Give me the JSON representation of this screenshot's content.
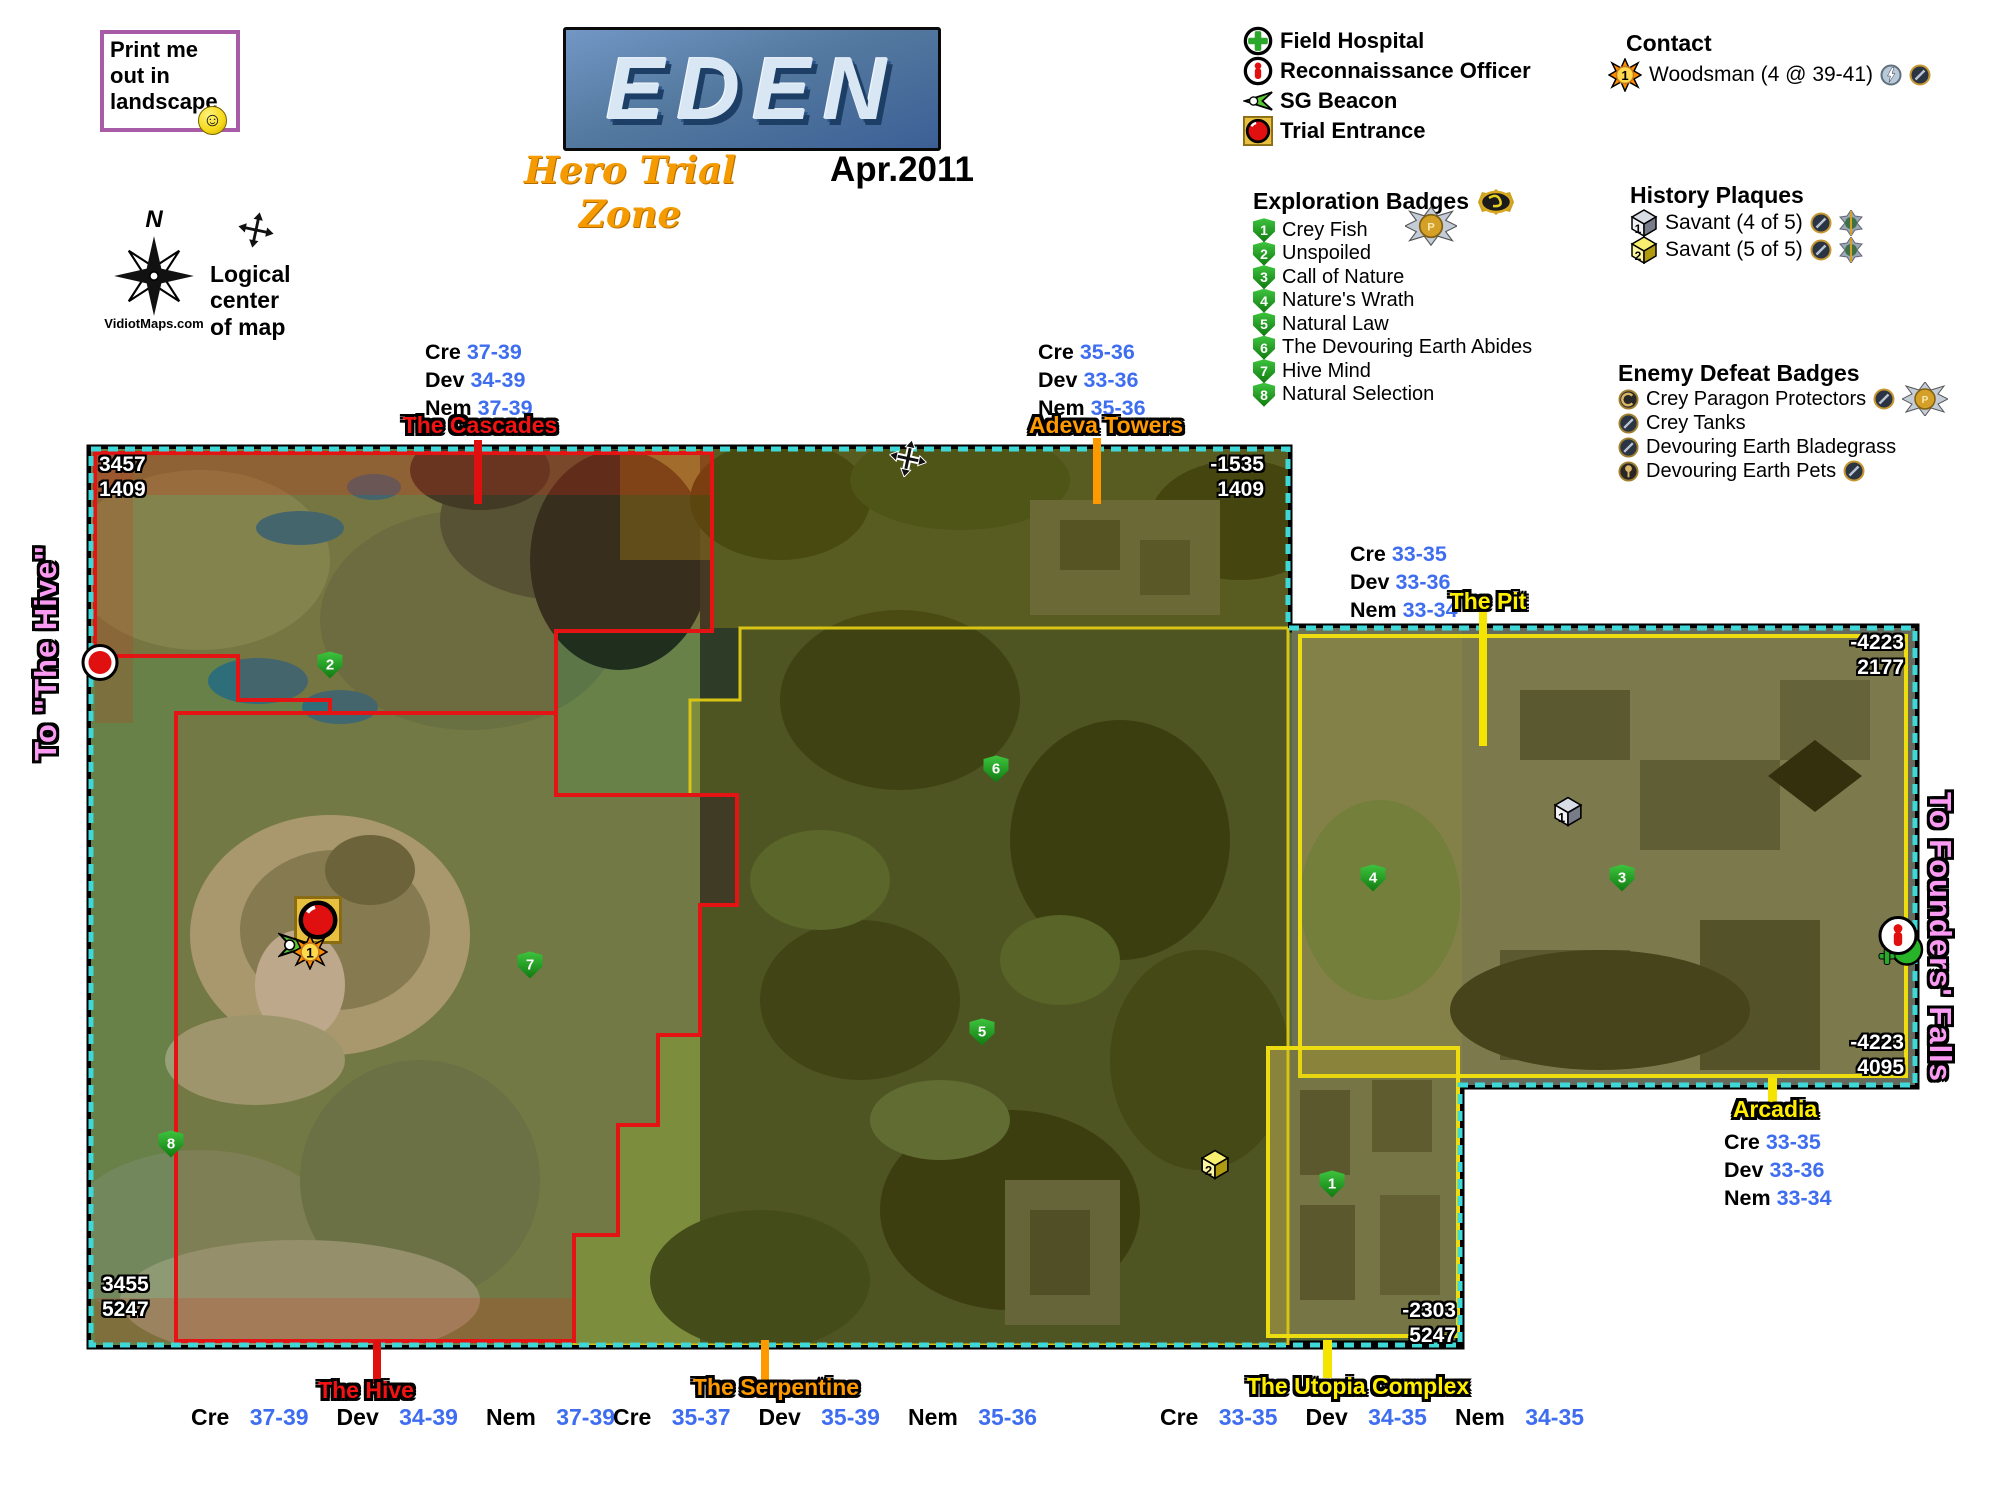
{
  "print_note": {
    "text": "Print me out in landscape",
    "smiley": "☺"
  },
  "title": {
    "name": "EDEN",
    "subtitle": "Hero Trial Zone",
    "date": "Apr.2011"
  },
  "compass": {
    "north": "N",
    "site": "VidiotMaps.com",
    "logical_center": "Logical center of map"
  },
  "legend": {
    "items": [
      {
        "icon": "field-hospital-icon",
        "label": "Field Hospital"
      },
      {
        "icon": "recon-officer-icon",
        "label": "Reconnaissance Officer"
      },
      {
        "icon": "sg-beacon-icon",
        "label": "SG Beacon"
      },
      {
        "icon": "trial-entrance-icon",
        "label": "Trial Entrance"
      }
    ]
  },
  "contact": {
    "heading": "Contact",
    "number": "1",
    "label": "Woodsman (4 @ 39-41)"
  },
  "exploration": {
    "heading": "Exploration Badges",
    "items": [
      {
        "num": "1",
        "label": "Crey Fish"
      },
      {
        "num": "2",
        "label": "Unspoiled"
      },
      {
        "num": "3",
        "label": "Call of Nature"
      },
      {
        "num": "4",
        "label": "Nature's Wrath"
      },
      {
        "num": "5",
        "label": "Natural Law"
      },
      {
        "num": "6",
        "label": "The Devouring Earth Abides"
      },
      {
        "num": "7",
        "label": "Hive Mind"
      },
      {
        "num": "8",
        "label": "Natural Selection"
      }
    ]
  },
  "history": {
    "heading": "History Plaques",
    "items": [
      {
        "num": "1",
        "label": "Savant (4 of 5)",
        "style": "grey"
      },
      {
        "num": "2",
        "label": "Savant (5 of 5)",
        "style": "gold"
      }
    ]
  },
  "enemy": {
    "heading": "Enemy Defeat Badges",
    "items": [
      {
        "label": "Crey Paragon Protectors"
      },
      {
        "label": "Crey Tanks"
      },
      {
        "label": "Devouring Earth Bladegrass"
      },
      {
        "label": "Devouring Earth Pets"
      }
    ]
  },
  "sides": {
    "left": "To \"The Hive\"",
    "right": "To Founders' Falls"
  },
  "stat_labels": {
    "cre": "Cre",
    "dev": "Dev",
    "nem": "Nem"
  },
  "zones": [
    {
      "name": "The Cascades",
      "color": "#f21212",
      "cre": "37-39",
      "dev": "34-39",
      "nem": "37-39"
    },
    {
      "name": "Adeva Towers",
      "color": "#ff9900",
      "cre": "35-36",
      "dev": "33-36",
      "nem": "35-36"
    },
    {
      "name": "The Pit",
      "color": "#ffee00",
      "cre": "33-35",
      "dev": "33-36",
      "nem": "33-34"
    },
    {
      "name": "Arcadia",
      "color": "#ffee00",
      "cre": "33-35",
      "dev": "33-36",
      "nem": "33-34"
    },
    {
      "name": "The Hive",
      "color": "#f21212",
      "cre": "37-39",
      "dev": "34-39",
      "nem": "37-39"
    },
    {
      "name": "The Serpentine",
      "color": "#ff9900",
      "cre": "35-37",
      "dev": "35-39",
      "nem": "35-36"
    },
    {
      "name": "The Utopia Complex",
      "color": "#ffee00",
      "cre": "33-35",
      "dev": "34-35",
      "nem": "34-35"
    }
  ],
  "map": {
    "corners": {
      "top_left": [
        "3457",
        "1409"
      ],
      "top_right": [
        "-1535",
        "1409"
      ],
      "right_upper": [
        "-4223",
        "2177"
      ],
      "right_lower": [
        "-4223",
        "4095"
      ],
      "bottom_left": [
        "3455",
        "5247"
      ],
      "bottom_right": [
        "-2303",
        "5247"
      ]
    },
    "exploration_markers": [
      {
        "num": "1",
        "x": 1332,
        "y": 1184
      },
      {
        "num": "2",
        "x": 330,
        "y": 665
      },
      {
        "num": "3",
        "x": 1622,
        "y": 878
      },
      {
        "num": "4",
        "x": 1373,
        "y": 878
      },
      {
        "num": "5",
        "x": 982,
        "y": 1032
      },
      {
        "num": "6",
        "x": 996,
        "y": 769
      },
      {
        "num": "7",
        "x": 530,
        "y": 965
      },
      {
        "num": "8",
        "x": 171,
        "y": 1144
      }
    ],
    "plaque_markers": [
      {
        "num": "1",
        "x": 1568,
        "y": 814,
        "style": "grey"
      },
      {
        "num": "2",
        "x": 1215,
        "y": 1167,
        "style": "gold"
      }
    ]
  }
}
